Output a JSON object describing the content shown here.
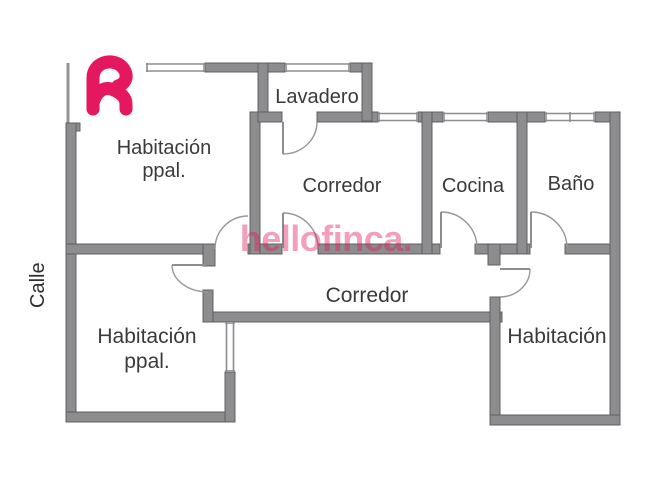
{
  "brand": {
    "watermark_text": "hellofinca.",
    "logo_icon": "hellofinca-h-logo"
  },
  "street": {
    "label": "Calle"
  },
  "rooms": {
    "hab_ppal_top": {
      "line1": "Habitación",
      "line2": "ppal."
    },
    "lavadero": {
      "label": "Lavadero"
    },
    "corredor_top": {
      "label": "Corredor"
    },
    "cocina": {
      "label": "Cocina"
    },
    "bano": {
      "label": "Baño"
    },
    "corredor_main": {
      "label": "Corredor"
    },
    "hab_ppal_bottom": {
      "line1": "Habitación",
      "line2": "ppal."
    },
    "habitacion_right": {
      "label": "Habitación"
    }
  },
  "colors": {
    "wall_fill": "#8d8d8f",
    "wall_stroke": "#606063",
    "label_text": "#3a3a3a",
    "brand_pink": "#e5175f",
    "watermark_pink": "#e31b5d"
  }
}
